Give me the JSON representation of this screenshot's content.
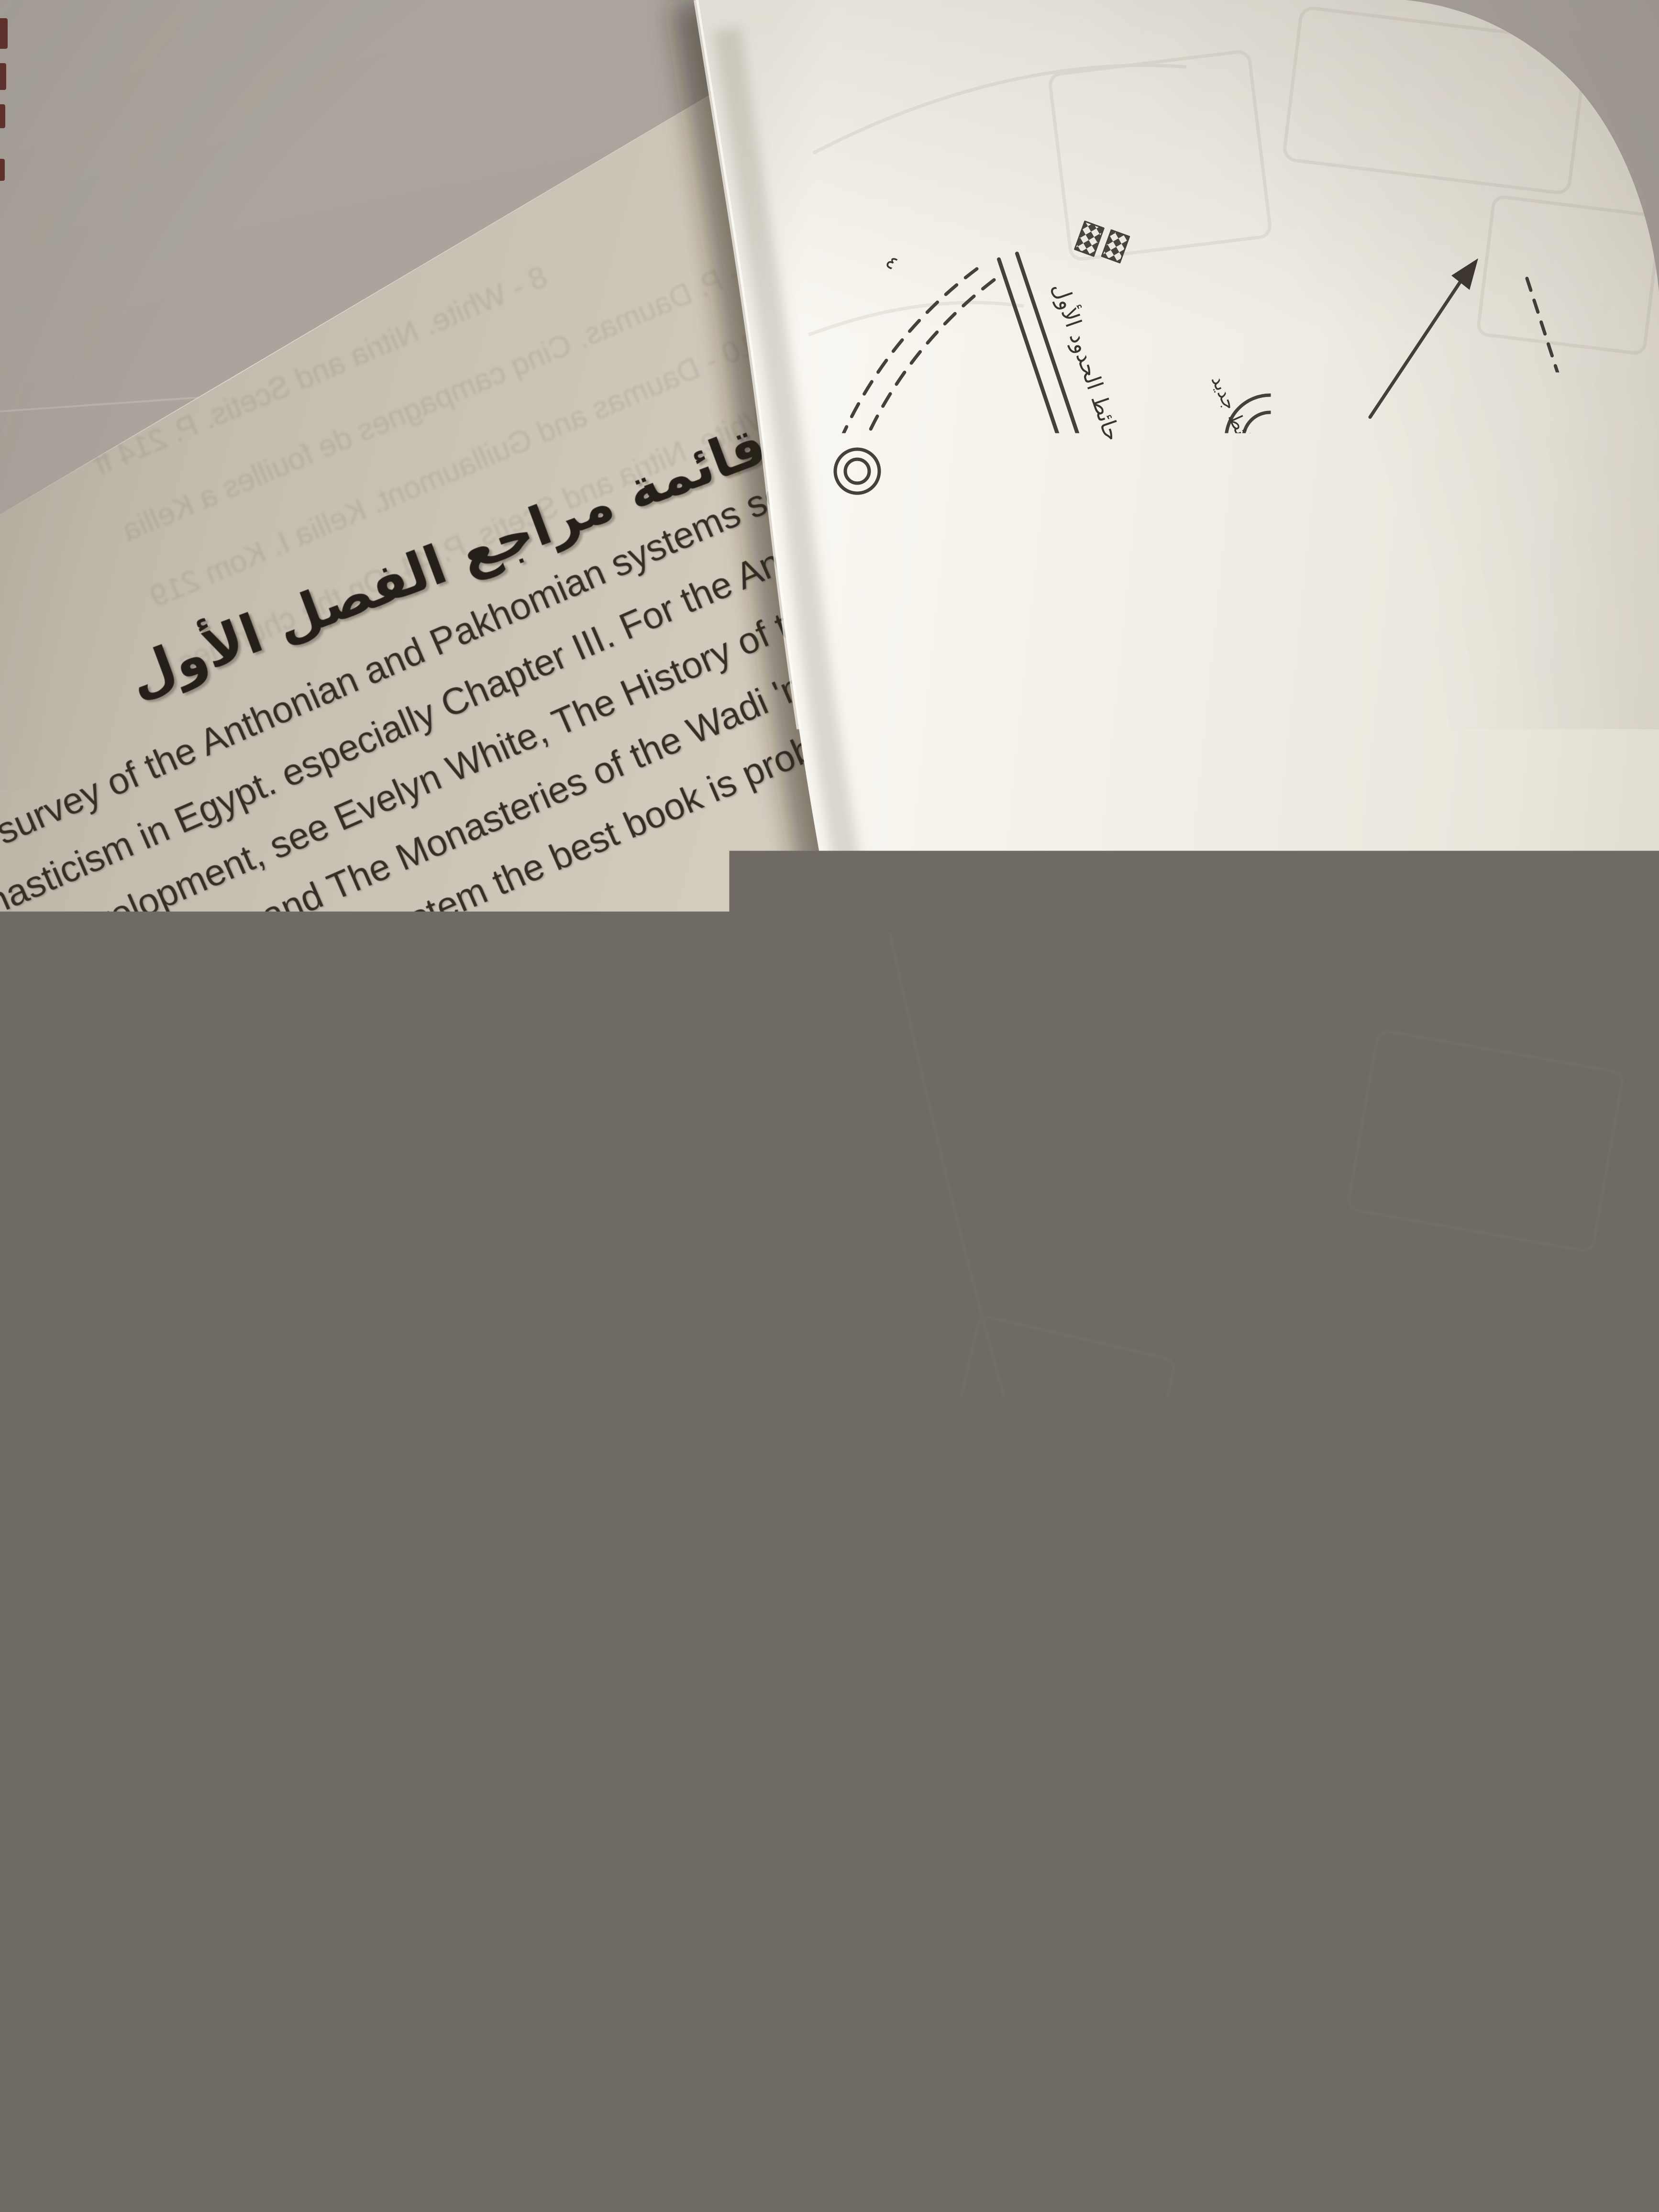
{
  "page_left": {
    "heading": "قائمة مراجع الفصل الأول",
    "references": [
      "a useful survey of the Anthonian and Pakhomian systems see W. Mac",
      "an Monasticism in Egypt. especially Chapter III.  For the Anthonian s",
      "gins and development, see Evelyn White, The History of the Monasteri",
      "nd Scetis,  Section 1, and The Monasteries of the Wadi 'n Natrun, Part 1",
      "ena 11 For the Pakhomian system the best book is probably still P.",
      "tude sur le cenobitisme Pakhomien.",
      "White, Wadi 'n Natrm 111, P. 5 ff.",
      "- See refs. in White, Wadi 'n Natrun 111, P. 5 note 1 .",
      "4 - H. Winlock and W. Crum, The Monastery of Epiphanius at Thebes.  Pa",
      "ff.",
      "5 - M. de Villard, Il monastero di S. Simeone presso Aswan, p. 156.",
      "6 - For Cellia the following : White, - Nitria-and scetis ; J.Jarry,. Descriptior",
      "stes d'un petit monastere aux Kellia'. in BIFAO.  Vol.  LXVI, pp.145 -Comptes",
      "us de l'Academie des Inscriptions et Belles Lettres (hereafter CRAIBL) 1965",
      "pp. 218-622 Octobre), pp. 384 - 390, 1966 Avril-juin). pp. 300 - 309, 1967 Octo",
      "pp. 438 - 450: R. Kasser.  Kellia (Geneva 1967): F. Daumas and A. Gui'aumont",
      "lia I (Korn 219), 2 fascicules (Cairo 1969). For Esna the following: Francis 'Abd (",
      "lek Gattas, 'Decouvertes d'un ensem ble souterrain copte dans le desert d'",
      "ASAE, Vol. 54 . pp. 245 - 249 ;",
      "S.  Sauneron,  'Les ermitages du desert', BIFAO.  Vol.  LXVII, pp. 103 - 11",
      "S.  Sauneron, \"Fouilles d`Esna: monast'eres et ermitagest. in CRAIBL",
      "(Septembre). p. 4 ll ff.",
      "7 - White, Wadi Natrun 111, P.8."
    ],
    "ghost_lines": [
      "8 - White. Nitria and Scetis. P. 214 ff",
      "9 - P. Daumas. Cinq campagnes de fouilles a Kellia",
      "10 - Daumas and Guillaumont. Kellia I. Kom 219",
      "11 - White. Nitria and Scetis. P. 44. On the churches",
      "15 - W. Muller-Wiener. Christliche Monumente",
      "16 - MDAIK Band 19 (1963) pp. 121 - 132. And in general",
      "17 - For Bawit see CRAIBL. 1913 (Juin). p. 287 ff"
    ]
  },
  "page_right": {
    "plan_labels": {
      "boundary_wall": "حائط الحدود الأول",
      "wall_2": "حائط جديد",
      "gate": "باب الدير",
      "marks": [
        "٤",
        "٢٣",
        "٤",
        "ع",
        "٥",
        "٣"
      ]
    }
  },
  "colors": {
    "wall": "#a7a199",
    "page_left": "#d5cec1",
    "page_right": "#f3f0e9",
    "ink": "#342e27",
    "plan_ink": "#454039",
    "table_wood": "#8a6848",
    "cover_edge": "#571f1c"
  }
}
